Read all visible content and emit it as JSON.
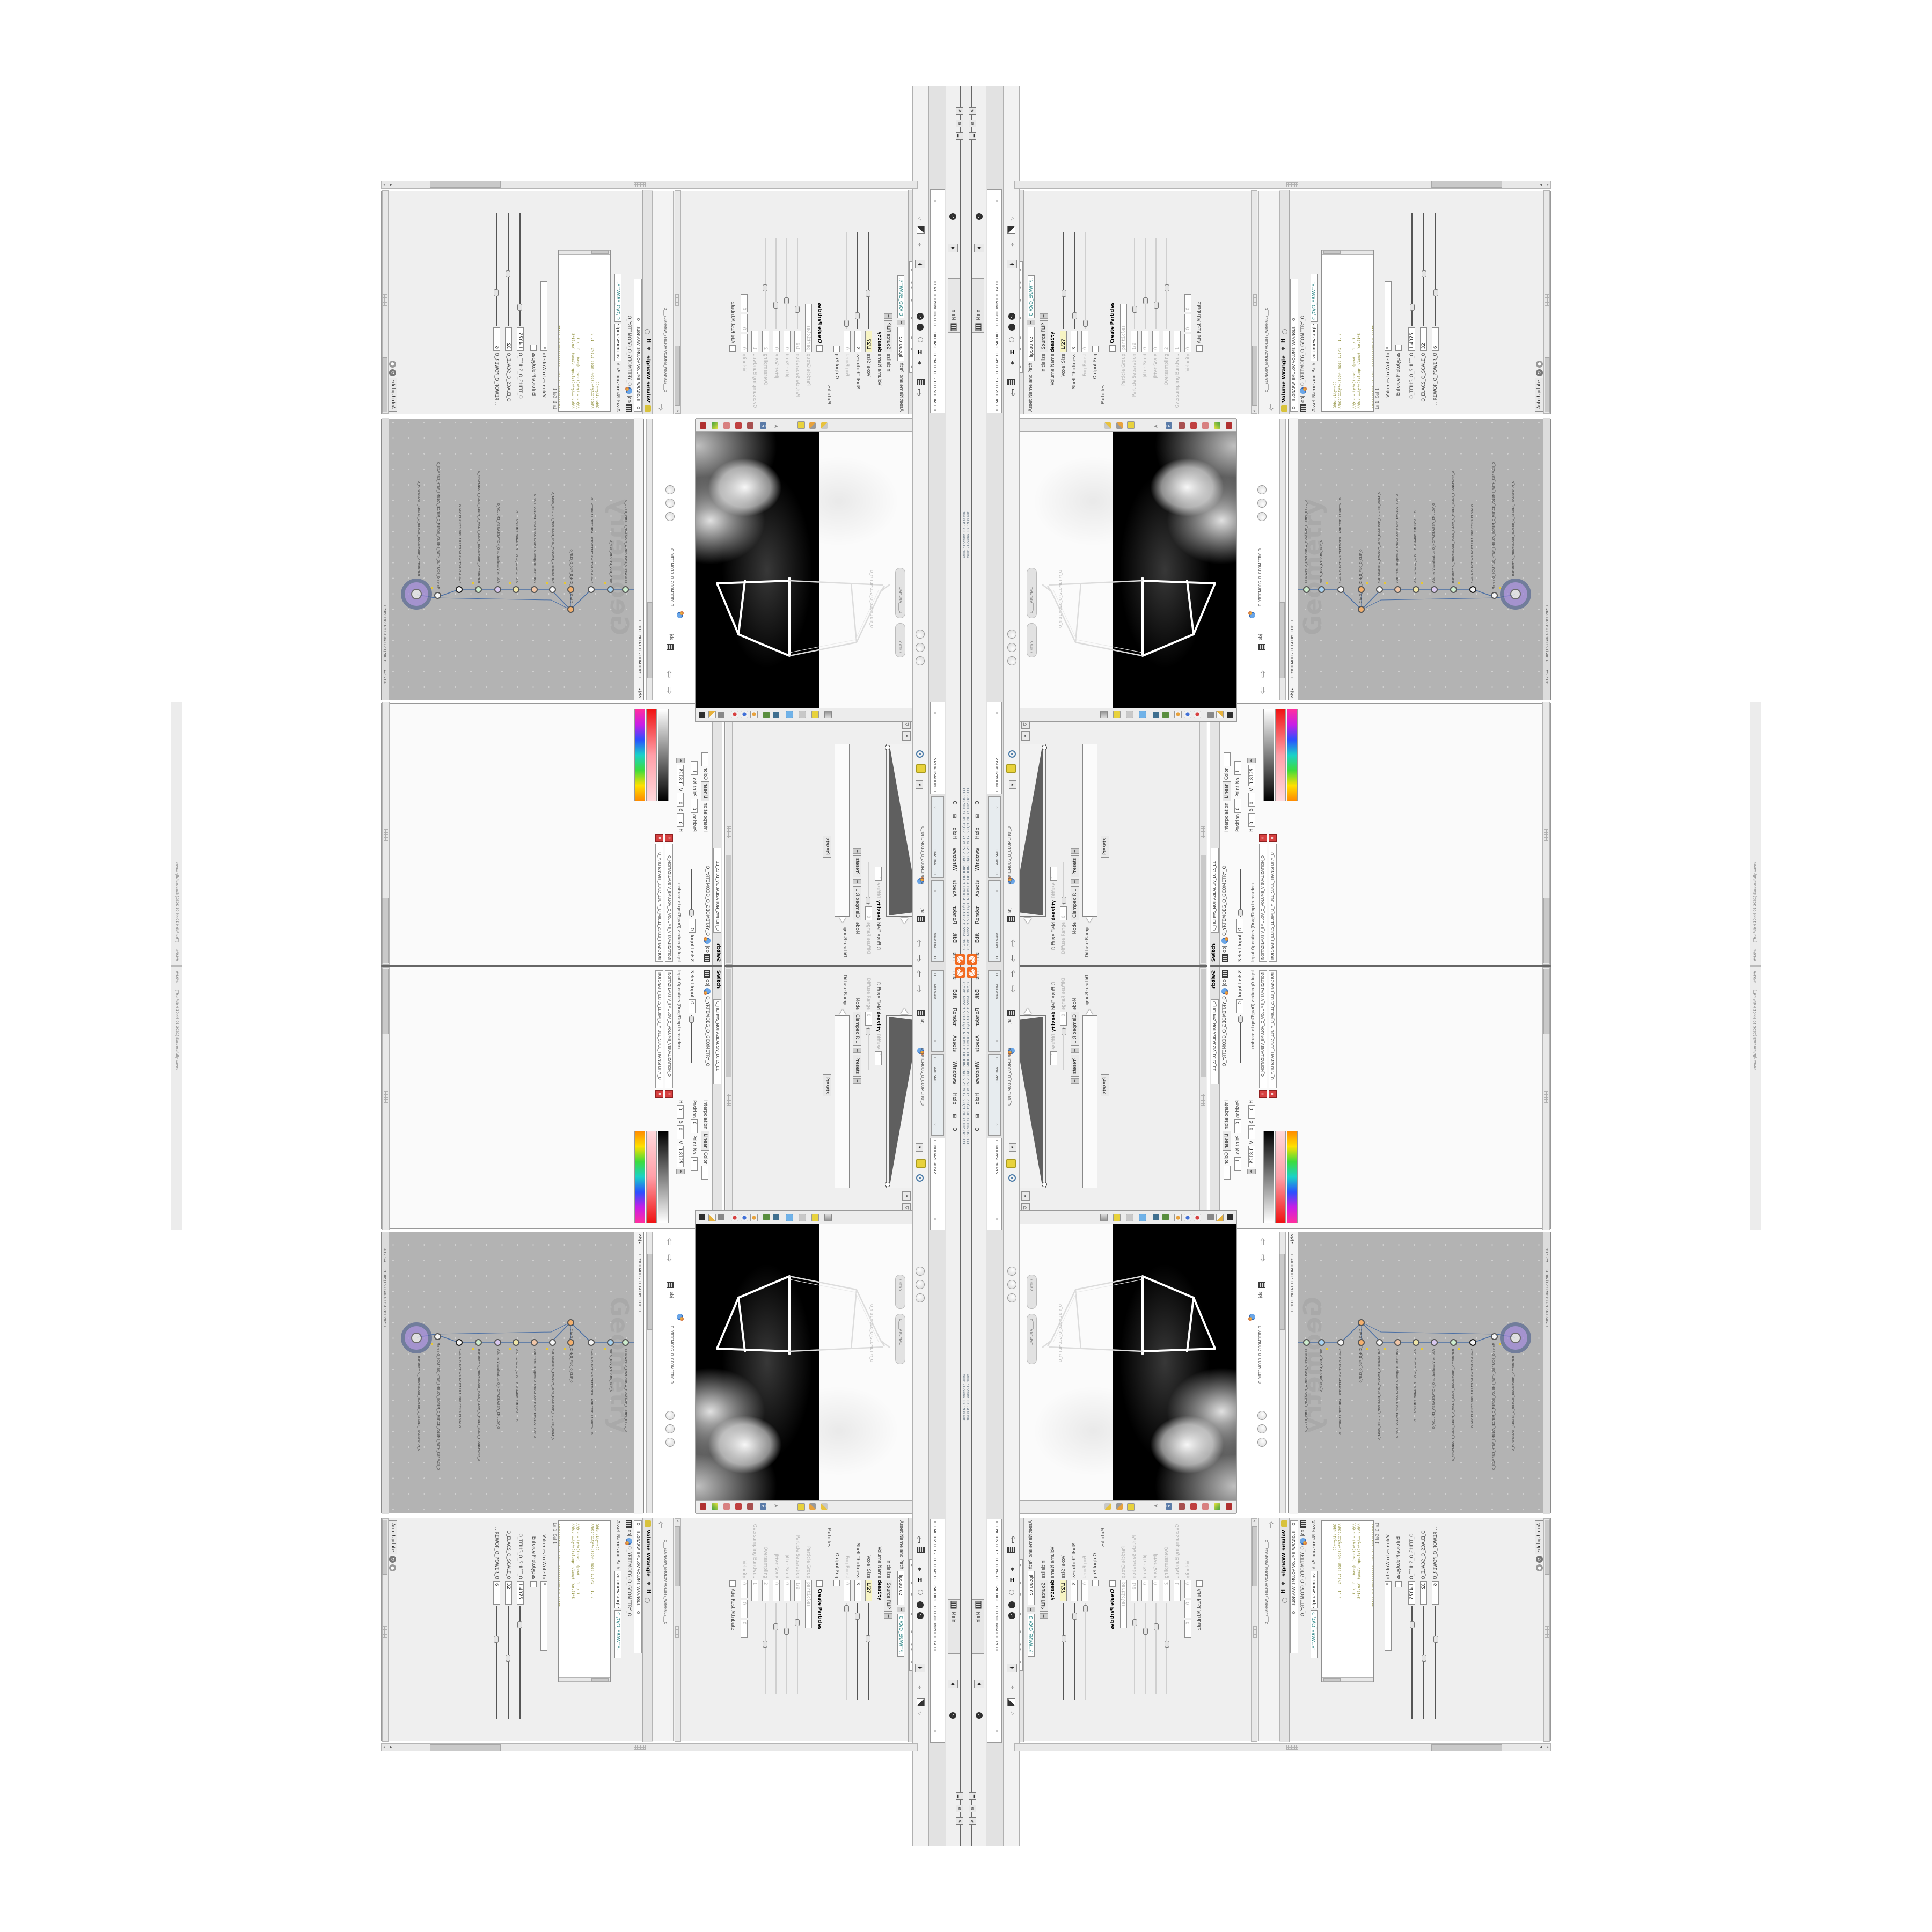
{
  "app": {
    "window_title": "OHIP - Houdini FX 19.0.490",
    "title_path": "C:/O/O_AIDIV_O_VIDIA_O/O_INIDUOH_O_HOUDINI_O/O_5_71_O_17_5_O/O_PIH_O_HIP_O/PIH.O",
    "menu": [
      "File",
      "Edit",
      "Render",
      "Assets",
      "Windows",
      "Help"
    ],
    "menu_extra": "O",
    "main_tab": "Main",
    "status_line": "#17_5#____O.HIP (Thu Feb 4 10:46:01 2021)",
    "status_edge": "#4.0%____[Thu Feb 4 10:46:01 2021]  Successfully saved",
    "logo_name": "houdini-logo"
  },
  "wrangle": {
    "title": "Volume Wrangle",
    "tab": "O___ELGNARW_EMULOV  VOLUME_WRANGLE___O",
    "node_tab": "volumewrangle",
    "breadcrumb": "obj",
    "breadcrumb_path": "O_YRTEMOEG_O_GEOMETRY_O",
    "asset_label": "Asset Name and Path",
    "asset_value": "C:/O/O_ERAWTF...",
    "code_lines": [
      "(@density*=((",
      "//@density*=((pow((mod(-1.)/1.  1. /",
      "//@density*=((pow(  (pow(   1. / 1.",
      "//@density*=((clamp( clamp( (cos(1*S",
      "//@density*=((-pow( (cos((clamp(GO_TFIHS",
      "//@density*=((-pow( -pow( (cos(GO_ELACS_O_SCAL",
      "//@density*=((pow(  clamp( (cos(GO_ELACS_O_SCA",
      "density*=((mod(("
    ],
    "footer": "Ln 1, Col 1",
    "volumes_label": "Volumes to Write to",
    "volumes_value": "*",
    "enforce_label": "Enforce Prototypes",
    "params": [
      {
        "label": "O_TFIHS_O_SHIFT_O",
        "value": "1.4375"
      },
      {
        "label": "O_ELACS_O_SCALE_O",
        "value": "32"
      },
      {
        "label": "...REWOP_O_POWER_O",
        "value": "6"
      }
    ],
    "update_mode": "Auto Update"
  },
  "flip": {
    "title": "FLIP Source",
    "tab": "O_EMULOV_LEHS_ELCITRAP_TICILPMI_DIULF_O_FLUID_IMPLICIT_PARTI...",
    "node_tab": "flipsource",
    "asset_label": "Asset Name and Path",
    "asset_value": "C:/O/O_ERAWTF...",
    "rows": [
      {
        "l": "Initialize",
        "v": "Source FLIP"
      },
      {
        "l": "Volume Name",
        "v": "density"
      },
      {
        "l": "Voxel Size",
        "v": "1/27"
      },
      {
        "l": "Shell Thickness",
        "v": "3"
      },
      {
        "l": "Fog Boost",
        "v": "0"
      },
      {
        "l": "Output Fog",
        "v": ""
      },
      {
        "l": "Particle Group",
        "v": "particles"
      },
      {
        "l": "Particle Separation",
        "v": "1/9"
      },
      {
        "l": "Jitter Seed",
        "v": "0"
      },
      {
        "l": "Jitter Scale",
        "v": "0"
      },
      {
        "l": "Oversampling",
        "v": "2"
      },
      {
        "l": "Oversampling Bandwi...",
        "v": "1"
      },
      {
        "l": "Velocity",
        "v": "0"
      }
    ],
    "section_particles": "Particles",
    "create_particles": "Create Particles",
    "add_rest": "Add Rest Attribute"
  },
  "volvis": {
    "title": "Volume Visualization",
    "tab": "O_NOITAZILAUSIV_EMULQ",
    "breadcrumb": "obj",
    "breadcrumb_path": "O_YRTEMOEG_O_GEOMETRY_O",
    "density_field_label": "Density Field",
    "density_field": "density",
    "mode_label": "Mode",
    "mode": "Clamped...",
    "density_menu": "Density",
    "density_ramp_label": "Density Ramp",
    "diffuse_field_label": "Diffuse Field",
    "diffuse_field": "density",
    "diffuse_label": "Diffuse",
    "diffuse_range_label": "Diffuse Range",
    "diffuse_range": "1",
    "mode2": "Clamped R...",
    "presets": "Presets",
    "diffuse_ramp_label": "Diffuse Ramp",
    "side_tab_1": "O____ARTNAM...",
    "side_tab_2": "O____AREMAC...",
    "side_tab_3": "O_NOITAZILAUSIV..."
  },
  "switchpane": {
    "title": "Switch",
    "tab": "O_HCTIWS_NOITAZILAUSIV_ECILS_EL",
    "breadcrumb": "obj",
    "breadcrumb_path": "O_YRTEMOEG_O_GEOMETRY_O",
    "select_label": "Select Input",
    "select_value": "0",
    "input_ops": "Input Operators (Drag/Drop to reorder)",
    "bar1": "NOITAZILAUSIV_EMULOV_O_VOLUME_VISUALIZATION_O",
    "bar2": "ROFSNART_ECILS_ELDIM_O_MIDLE_SLICE_TRANSFORM_O",
    "interp_label": "Interpolation",
    "interp": "Linear",
    "color_label": "Color",
    "position_label": "Position",
    "position": "0",
    "point_label": "Point No.",
    "point": "1",
    "h_label": "H",
    "h": "0",
    "s_label": "S",
    "s": "0",
    "v_label": "V",
    "v": "1.8125"
  },
  "network": {
    "watermark": "Geometry",
    "breadcrumb": "obj",
    "path": "O_YRTEMOEG_O_GEOMETRY_O",
    "nodes": [
      {
        "l": "Transform  O_MROFSNART_TLUSER_O_RESULT_TRANSFORM_O"
      },
      {
        "l": "Merge  O_ECAFRUS_HTIW_EMULOV_EGREM_O_MERGE_VOLUME_WITH_SURFACE_O"
      },
      {
        "l": "Switch  O_HCTIWS_NOITAZILAUSIV_ECILS_ELDIM_O"
      },
      {
        "l": "Transform  O_MROFSNART_ECILS_ELDIM_O_MIDLE_SLICE_TRANSFORM_O"
      },
      {
        "l": "Volume Visualization  O_NOITAZILAUSIV_EMULOV_O"
      },
      {
        "l": "Volume Wrangle  O___ELGNARW_EMULOV____O"
      },
      {
        "l": "VDB from Polygons  O_SNOGYLOP_MORF_EMULOV_BDV_O"
      },
      {
        "l": "FLIP Source  O_EMULOV_LEHS_ELCITRAP_TICILPMI_DIULF_O"
      },
      {
        "l": "Clip  O_PILC_DIM_O"
      },
      {
        "l": "Clip  O_PILC_O_CLIP_O"
      },
      {
        "l": "Switch  O_HCTIWS_YRTEMOEG_LANRETXE_LANRETNI_O"
      },
      {
        "l": "File  O_BDV_DERAHS_ELIF_O"
      },
      {
        "l": "BodyWire  O_EMARFERIW_NOGYLOP_EREHPS_EBUC_O"
      },
      {
        "l": "CubeSphere  O_EREHPS_EBUC_O_CUBE_SPHERE_O"
      }
    ]
  },
  "viewport": {
    "ortho_pill": "Ortho",
    "camera_pill": "O____AREMAC",
    "geom_label": "O_YRTEMOEG_O_GEOMETRY_O",
    "obj_label": "obj"
  },
  "colors": {
    "accent_orange": "#f26b21",
    "node_purple": "#a089d8",
    "yellow_field": "#f7f4c3",
    "network_bg": "#b3b3b3"
  }
}
